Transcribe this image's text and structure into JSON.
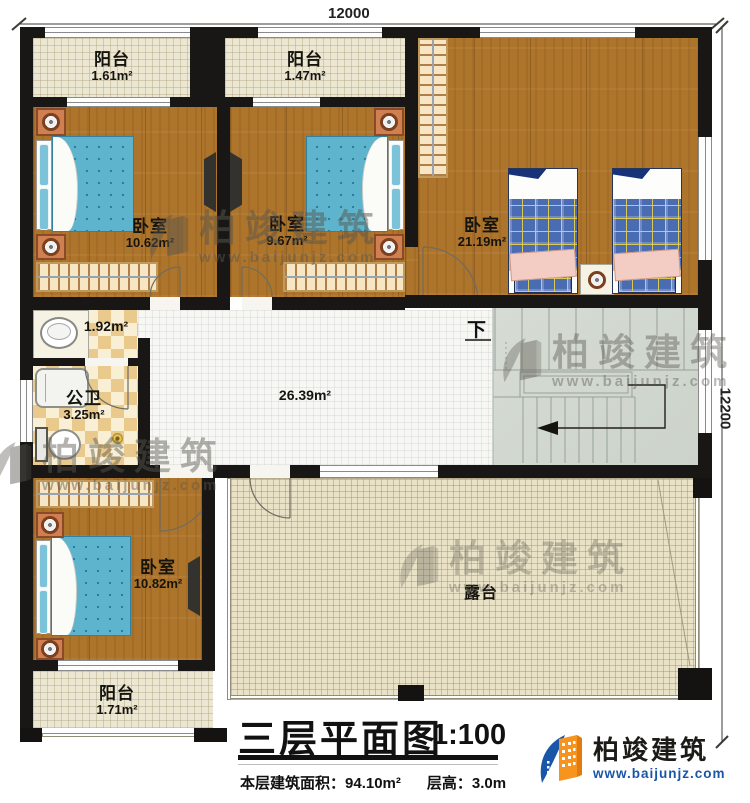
{
  "dimensions": {
    "top": "12000",
    "right": "12200"
  },
  "rooms": [
    {
      "id": "balcony-top-left",
      "label": "阳台",
      "area": "1.61m²"
    },
    {
      "id": "balcony-top-mid",
      "label": "阳台",
      "area": "1.47m²"
    },
    {
      "id": "bedroom-1",
      "label": "卧室",
      "area": "10.62m²"
    },
    {
      "id": "bedroom-2",
      "label": "卧室",
      "area": "9.67m²"
    },
    {
      "id": "bedroom-3",
      "label": "卧室",
      "area": "21.19m²"
    },
    {
      "id": "laundry",
      "label": "",
      "area": "1.92m²"
    },
    {
      "id": "bathroom",
      "label": "公卫",
      "area": "3.25m²"
    },
    {
      "id": "hall",
      "label": "",
      "area": "26.39m²"
    },
    {
      "id": "bedroom-4",
      "label": "卧室",
      "area": "10.82m²"
    },
    {
      "id": "balcony-bottom",
      "label": "阳台",
      "area": "1.71m²"
    },
    {
      "id": "terrace",
      "label": "露台",
      "area": ""
    }
  ],
  "stairs": {
    "down_label": "下"
  },
  "title_block": {
    "title": "三层平面图",
    "scale": "1:100",
    "area_label": "本层建筑面积：",
    "area_value": "94.10m²",
    "height_label": "层高：",
    "height_value": "3.0m"
  },
  "brand": {
    "name": "柏竣建筑",
    "website": "www.baijunjz.com"
  },
  "watermark": {
    "name": "柏竣建筑",
    "website": "www.baijunjz.com"
  },
  "colors": {
    "wall": "#181715",
    "wood": "#ad742c",
    "tile_cream": "#ece7d2",
    "tile_white": "#f7f7f4",
    "tile_terrace": "#eae2c6",
    "stair": "#d2d8d0",
    "checker_dark": "#e9c98c",
    "checker_light": "#f8efd5",
    "bed_blue": "#5fb4cd",
    "bed_plaid_blue": "#4a6cb2",
    "furniture_orange": "#d08050",
    "logo_blue": "#1a56a8",
    "logo_orange": "#f7941d"
  }
}
